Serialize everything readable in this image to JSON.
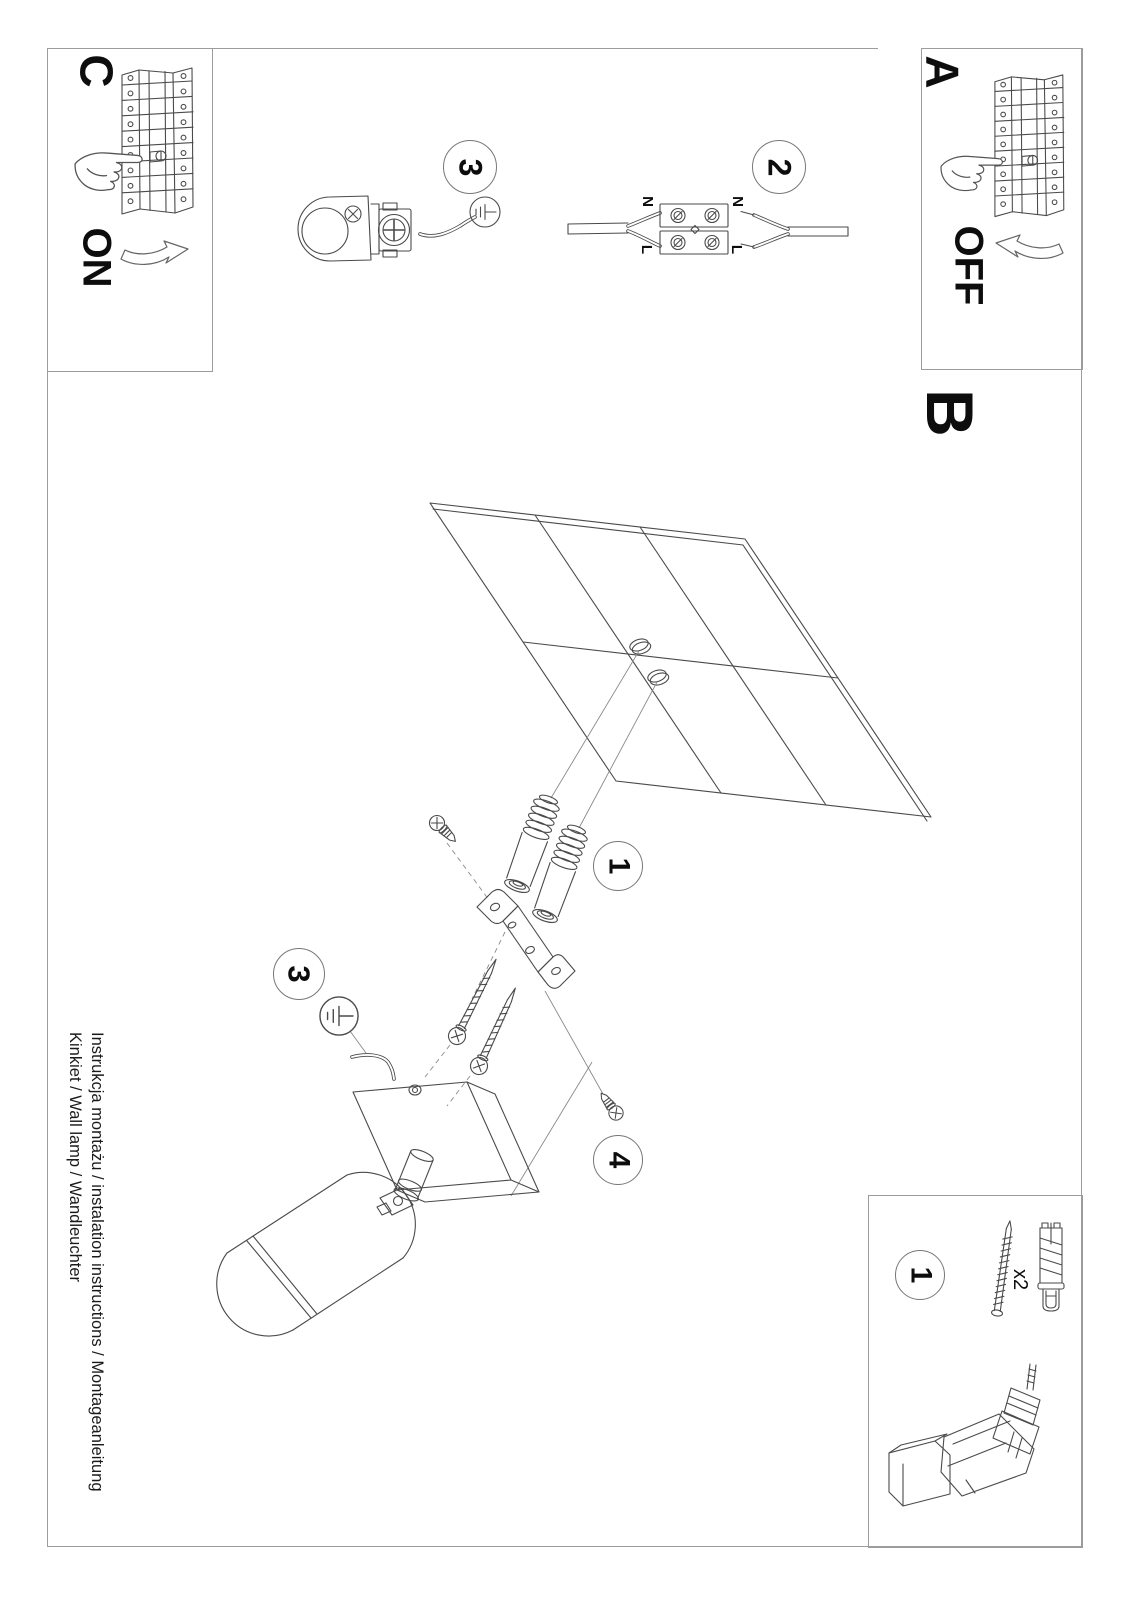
{
  "document": {
    "footer": {
      "line1": "Instrukcja montażu / instalation instructions / Montageanleitung",
      "line2": "Kinkiet / Wall lamp / Wandleuchter"
    }
  },
  "sections": {
    "power_on": {
      "label": "C",
      "state": "ON"
    },
    "power_off": {
      "label": "A",
      "state": "OFF"
    },
    "mounting": {
      "label": "B"
    }
  },
  "callouts": {
    "anchors": "1",
    "connector": "2",
    "ground_top": "3",
    "ground_lamp": "3",
    "fixing_screw": "4",
    "parts": "1"
  },
  "connector_labels": {
    "left_n": "N",
    "left_l": "L",
    "right_n": "N",
    "right_l": "L"
  },
  "parts_box": {
    "quantity": "x2"
  }
}
